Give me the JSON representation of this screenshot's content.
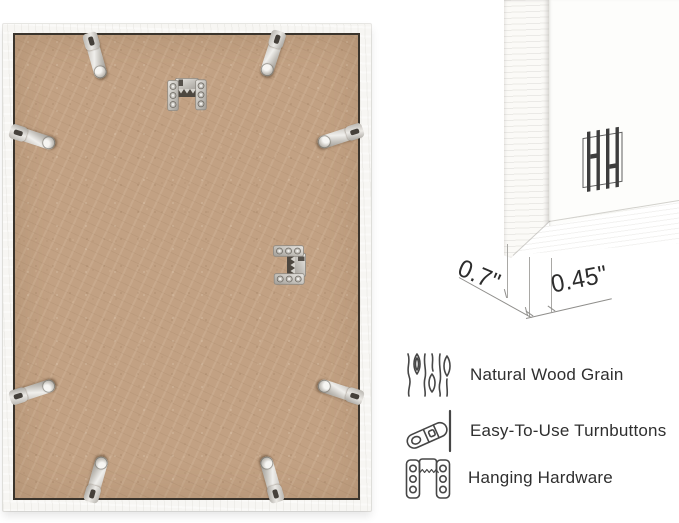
{
  "canvas": {
    "background": "#ffffff"
  },
  "frame_back_photo": {
    "colors": {
      "frame_white": "#f7f6f3",
      "backing_tan": "#c2a183",
      "backing_outline": "#3a342c",
      "metal_silver": "#cbc8c3"
    }
  },
  "corner_detail_photo": {
    "depth_label": "0.7\"",
    "face_label": "0.45\""
  },
  "features": {
    "rows": [
      {
        "icon": "wood-grain-icon",
        "label": "Natural Wood Grain"
      },
      {
        "icon": "turnbutton-icon",
        "label": "Easy-To-Use Turnbuttons"
      },
      {
        "icon": "hanging-hardware-icon",
        "label": "Hanging Hardware"
      }
    ]
  }
}
